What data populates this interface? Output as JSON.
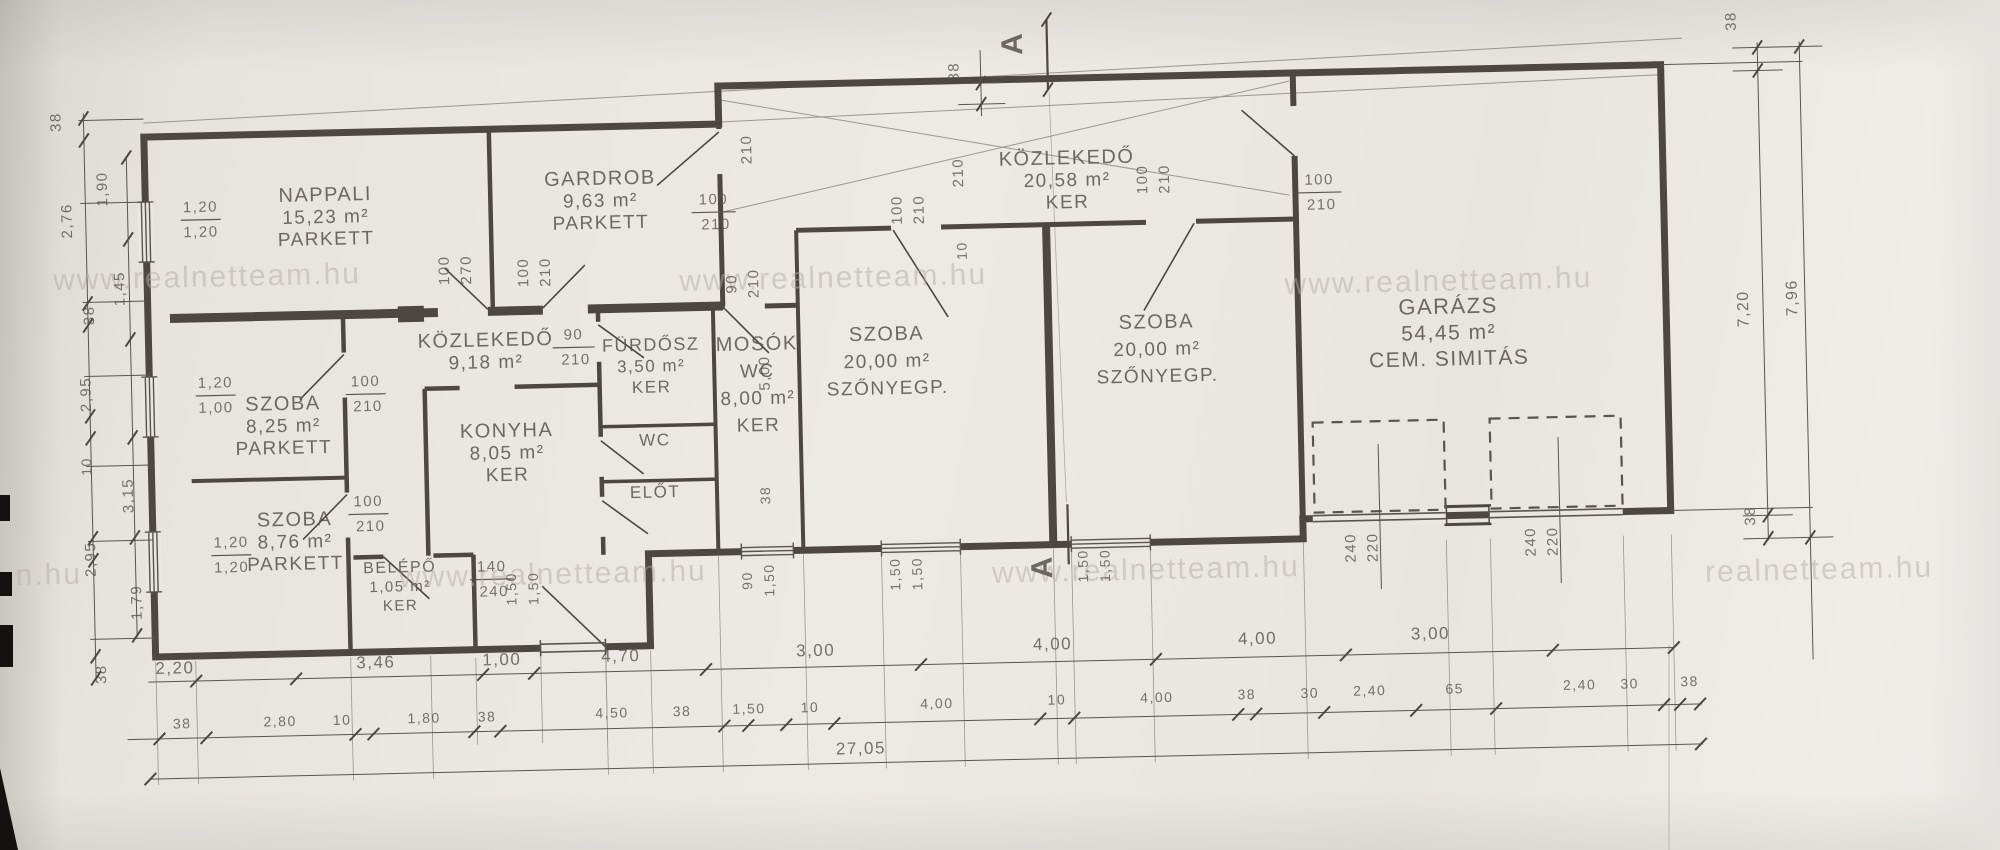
{
  "watermark": {
    "text": "www.realnetteam.hu",
    "color": "#b3ada4"
  },
  "watermarks": [
    {
      "x": 210,
      "y": 271,
      "t": "www.realnetteam.hu"
    },
    {
      "x": 836,
      "y": 286,
      "t": "www.realnetteam.hu"
    },
    {
      "x": 1441,
      "y": 303,
      "t": "www.realnetteam.hu"
    },
    {
      "x": 549,
      "y": 576,
      "t": "www.realnetteam.hu"
    },
    {
      "x": 1142,
      "y": 585,
      "t": "www.realnetteam.hu"
    },
    {
      "x": 1815,
      "y": 600,
      "t": "realnetteam.hu"
    },
    {
      "x": 45,
      "y": 565,
      "t": "n.hu"
    }
  ],
  "rooms": [
    {
      "id": "nappali",
      "lines": [
        "NAPPALI",
        "15,23 m²",
        "PARKETT"
      ],
      "x": 330,
      "y": 188
    },
    {
      "id": "gardrob",
      "lines": [
        "GARDROB",
        "9,63 m²",
        "PARKETT"
      ],
      "x": 605,
      "y": 178
    },
    {
      "id": "kozlekedo-1",
      "lines": [
        "KÖZLEKEDŐ",
        "9,18 m²"
      ],
      "x": 487,
      "y": 337
    },
    {
      "id": "szoba-825",
      "lines": [
        "SZOBA",
        "8,25 m²",
        "PARKETT"
      ],
      "x": 283,
      "y": 396
    },
    {
      "id": "szoba-876",
      "lines": [
        "SZOBA",
        "8,76 m²",
        "PARKETT"
      ],
      "x": 292,
      "y": 512
    },
    {
      "id": "belepo",
      "lines": [
        "BELÉPŐ",
        "1,05 m²",
        "KER"
      ],
      "x": 396,
      "y": 561,
      "s": 16,
      "dy": 19
    },
    {
      "id": "konyha",
      "lines": [
        "KONYHA",
        "8,05 m²",
        "KER"
      ],
      "x": 506,
      "y": 428
    },
    {
      "id": "furdosz",
      "lines": [
        "FÜRDŐSZ",
        "3,50 m²",
        "KER"
      ],
      "x": 652,
      "y": 345,
      "s": 18,
      "dy": 21
    },
    {
      "id": "wc",
      "lines": [
        "WC"
      ],
      "x": 654,
      "y": 440,
      "s": 17
    },
    {
      "id": "elot",
      "lines": [
        "ELŐT"
      ],
      "x": 653,
      "y": 492,
      "s": 17
    },
    {
      "id": "mosok",
      "lines": [
        "MOSÓK",
        "WC",
        "8,00 m²",
        "KER"
      ],
      "x": 758,
      "y": 347,
      "dy": 27
    },
    {
      "id": "szoba-20-1",
      "lines": [
        "SZOBA",
        "20,00 m²",
        "SZŐNYEGP."
      ],
      "x": 888,
      "y": 340,
      "dy": 27
    },
    {
      "id": "szoba-20-2",
      "lines": [
        "SZOBA",
        "20,00 m²",
        "SZŐNYEGP."
      ],
      "x": 1158,
      "y": 334,
      "dy": 27
    },
    {
      "id": "kozlekedo-2",
      "lines": [
        "KÖZLEKEDŐ",
        "20,58 m²",
        "KER"
      ],
      "x": 1072,
      "y": 168
    },
    {
      "id": "garazs",
      "lines": [
        "GARÁZS",
        "54,45 m²",
        "CEM. SIMITÁS"
      ],
      "x": 1450,
      "y": 326,
      "s": 22,
      "dy": 26
    }
  ],
  "dims": [
    {
      "t": "2,20",
      "x": 169,
      "y": 657,
      "s": 17
    },
    {
      "t": "3,46",
      "x": 370,
      "y": 656,
      "s": 17
    },
    {
      "t": "1,00",
      "x": 496,
      "y": 656,
      "s": 17
    },
    {
      "t": "4,70",
      "x": 615,
      "y": 655,
      "s": 17
    },
    {
      "t": "3,00",
      "x": 810,
      "y": 654,
      "s": 17
    },
    {
      "t": "4,00",
      "x": 1047,
      "y": 653,
      "s": 17
    },
    {
      "t": "4,00",
      "x": 1252,
      "y": 652,
      "s": 17
    },
    {
      "t": "3,00",
      "x": 1425,
      "y": 651,
      "s": 17
    },
    {
      "t": "38",
      "x": 175,
      "y": 712,
      "s": 14
    },
    {
      "t": "2,80",
      "x": 273,
      "y": 712,
      "s": 14
    },
    {
      "t": "10",
      "x": 335,
      "y": 712,
      "s": 14
    },
    {
      "t": "1,80",
      "x": 417,
      "y": 712,
      "s": 14
    },
    {
      "t": "38",
      "x": 480,
      "y": 712,
      "s": 14
    },
    {
      "t": "4,50",
      "x": 605,
      "y": 711,
      "s": 14
    },
    {
      "t": "38",
      "x": 675,
      "y": 711,
      "s": 14
    },
    {
      "t": "1,50",
      "x": 742,
      "y": 710,
      "s": 14
    },
    {
      "t": "10",
      "x": 803,
      "y": 710,
      "s": 14
    },
    {
      "t": "4,00",
      "x": 930,
      "y": 709,
      "s": 14
    },
    {
      "t": "10",
      "x": 1050,
      "y": 708,
      "s": 14
    },
    {
      "t": "4,00",
      "x": 1150,
      "y": 708,
      "s": 14
    },
    {
      "t": "38",
      "x": 1240,
      "y": 707,
      "s": 14
    },
    {
      "t": "30",
      "x": 1303,
      "y": 707,
      "s": 14
    },
    {
      "t": "2,40",
      "x": 1363,
      "y": 706,
      "s": 14
    },
    {
      "t": "65",
      "x": 1448,
      "y": 706,
      "s": 14
    },
    {
      "t": "2,40",
      "x": 1573,
      "y": 705,
      "s": 14
    },
    {
      "t": "30",
      "x": 1623,
      "y": 705,
      "s": 14
    },
    {
      "t": "38",
      "x": 1683,
      "y": 704,
      "s": 14
    },
    {
      "t": "27,05",
      "x": 853,
      "y": 753,
      "s": 17
    },
    {
      "t": "1,20",
      "x": 205,
      "y": 196,
      "s": 15
    },
    {
      "t": "1,20",
      "x": 205,
      "y": 221,
      "s": 15
    },
    {
      "t": "1,20",
      "x": 216,
      "y": 372,
      "s": 15
    },
    {
      "t": "1,00",
      "x": 216,
      "y": 397,
      "s": 15
    },
    {
      "t": "1,20",
      "x": 228,
      "y": 532,
      "s": 15
    },
    {
      "t": "1,20",
      "x": 228,
      "y": 557,
      "s": 15
    },
    {
      "t": "100",
      "x": 366,
      "y": 374,
      "s": 15
    },
    {
      "t": "210",
      "x": 368,
      "y": 399,
      "s": 15
    },
    {
      "t": "100",
      "x": 366,
      "y": 494,
      "s": 15
    },
    {
      "t": "210",
      "x": 368,
      "y": 519,
      "s": 15
    },
    {
      "t": "100",
      "x": 718,
      "y": 200,
      "s": 15
    },
    {
      "t": "210",
      "x": 720,
      "y": 225,
      "s": 15
    },
    {
      "t": "90",
      "x": 575,
      "y": 332,
      "s": 15
    },
    {
      "t": "210",
      "x": 577,
      "y": 357,
      "s": 15
    },
    {
      "t": "100",
      "x": 1324,
      "y": 194,
      "s": 15
    },
    {
      "t": "210",
      "x": 1326,
      "y": 219,
      "s": 15
    },
    {
      "t": "140",
      "x": 488,
      "y": 562,
      "s": 15
    },
    {
      "t": "240",
      "x": 490,
      "y": 587,
      "s": 15
    },
    {
      "t": "100",
      "x": 452,
      "y": 260,
      "r": -90,
      "s": 15
    },
    {
      "t": "270",
      "x": 474,
      "y": 260,
      "r": -90,
      "s": 15
    },
    {
      "t": "100",
      "x": 531,
      "y": 264,
      "r": -90,
      "s": 15
    },
    {
      "t": "210",
      "x": 553,
      "y": 264,
      "r": -90,
      "s": 15
    },
    {
      "t": "90",
      "x": 739,
      "y": 280,
      "r": -90,
      "s": 15
    },
    {
      "t": "210",
      "x": 761,
      "y": 280,
      "r": -90,
      "s": 15
    },
    {
      "t": "100",
      "x": 906,
      "y": 210,
      "r": -90,
      "s": 15
    },
    {
      "t": "210",
      "x": 928,
      "y": 210,
      "r": -90,
      "s": 15
    },
    {
      "t": "100",
      "x": 1152,
      "y": 185,
      "r": -90,
      "s": 15
    },
    {
      "t": "210",
      "x": 1174,
      "y": 185,
      "r": -90,
      "s": 15
    },
    {
      "t": "210",
      "x": 757,
      "y": 146,
      "r": -90,
      "s": 15
    },
    {
      "t": "210",
      "x": 968,
      "y": 174,
      "r": -90,
      "s": 15
    },
    {
      "t": "10",
      "x": 970,
      "y": 252,
      "r": -90,
      "s": 14
    },
    {
      "t": "5,00",
      "x": 770,
      "y": 370,
      "r": -90,
      "s": 15
    },
    {
      "t": "38",
      "x": 768,
      "y": 492,
      "r": -90,
      "s": 14
    },
    {
      "t": "38",
      "x": 966,
      "y": 73,
      "r": -90,
      "s": 15
    },
    {
      "t": "90",
      "x": 748,
      "y": 577,
      "r": -90,
      "s": 14
    },
    {
      "t": "1,50",
      "x": 770,
      "y": 577,
      "r": -90,
      "s": 14
    },
    {
      "t": "1,50",
      "x": 896,
      "y": 574,
      "r": -90,
      "s": 14
    },
    {
      "t": "1,50",
      "x": 918,
      "y": 574,
      "r": -90,
      "s": 14
    },
    {
      "t": "1,50",
      "x": 1084,
      "y": 570,
      "r": -90,
      "s": 14
    },
    {
      "t": "1,50",
      "x": 1106,
      "y": 570,
      "r": -90,
      "s": 14
    },
    {
      "t": "1,50",
      "x": 512,
      "y": 580,
      "r": -90,
      "s": 14
    },
    {
      "t": "1,50",
      "x": 534,
      "y": 580,
      "r": -90,
      "s": 14
    },
    {
      "t": "240",
      "x": 1352,
      "y": 558,
      "r": -90,
      "s": 15
    },
    {
      "t": "220",
      "x": 1374,
      "y": 558,
      "r": -90,
      "s": 15
    },
    {
      "t": "240",
      "x": 1532,
      "y": 556,
      "r": -90,
      "s": 15
    },
    {
      "t": "220",
      "x": 1554,
      "y": 556,
      "r": -90,
      "s": 15
    },
    {
      "t": "38",
      "x": 67,
      "y": 103,
      "r": -90,
      "s": 15
    },
    {
      "t": "2,76",
      "x": 76,
      "y": 202,
      "r": -90,
      "s": 15
    },
    {
      "t": "38",
      "x": 96,
      "y": 297,
      "r": -90,
      "s": 15
    },
    {
      "t": "2,95",
      "x": 91,
      "y": 376,
      "r": -90,
      "s": 15
    },
    {
      "t": "10",
      "x": 90,
      "y": 448,
      "r": -90,
      "s": 14
    },
    {
      "t": "2,95",
      "x": 92,
      "y": 541,
      "r": -90,
      "s": 15
    },
    {
      "t": "38",
      "x": 100,
      "y": 656,
      "r": -90,
      "s": 15
    },
    {
      "t": "1,90",
      "x": 112,
      "y": 171,
      "r": -90,
      "s": 15
    },
    {
      "t": "1,45",
      "x": 127,
      "y": 271,
      "r": -90,
      "s": 15
    },
    {
      "t": "3,15",
      "x": 131,
      "y": 478,
      "r": -90,
      "s": 15
    },
    {
      "t": "1,79",
      "x": 137,
      "y": 585,
      "r": -90,
      "s": 15
    },
    {
      "t": "38",
      "x": 1744,
      "y": 40,
      "r": -90,
      "s": 15
    },
    {
      "t": "7,20",
      "x": 1750,
      "y": 328,
      "r": -90,
      "s": 16
    },
    {
      "t": "7,96",
      "x": 1799,
      "y": 318,
      "r": -90,
      "s": 16
    },
    {
      "t": "38",
      "x": 1752,
      "y": 535,
      "r": -90,
      "s": 15
    }
  ],
  "section_markers": [
    {
      "t": "A",
      "x": 1030,
      "y": 46
    },
    {
      "t": "A",
      "x": 1048,
      "y": 570
    }
  ]
}
